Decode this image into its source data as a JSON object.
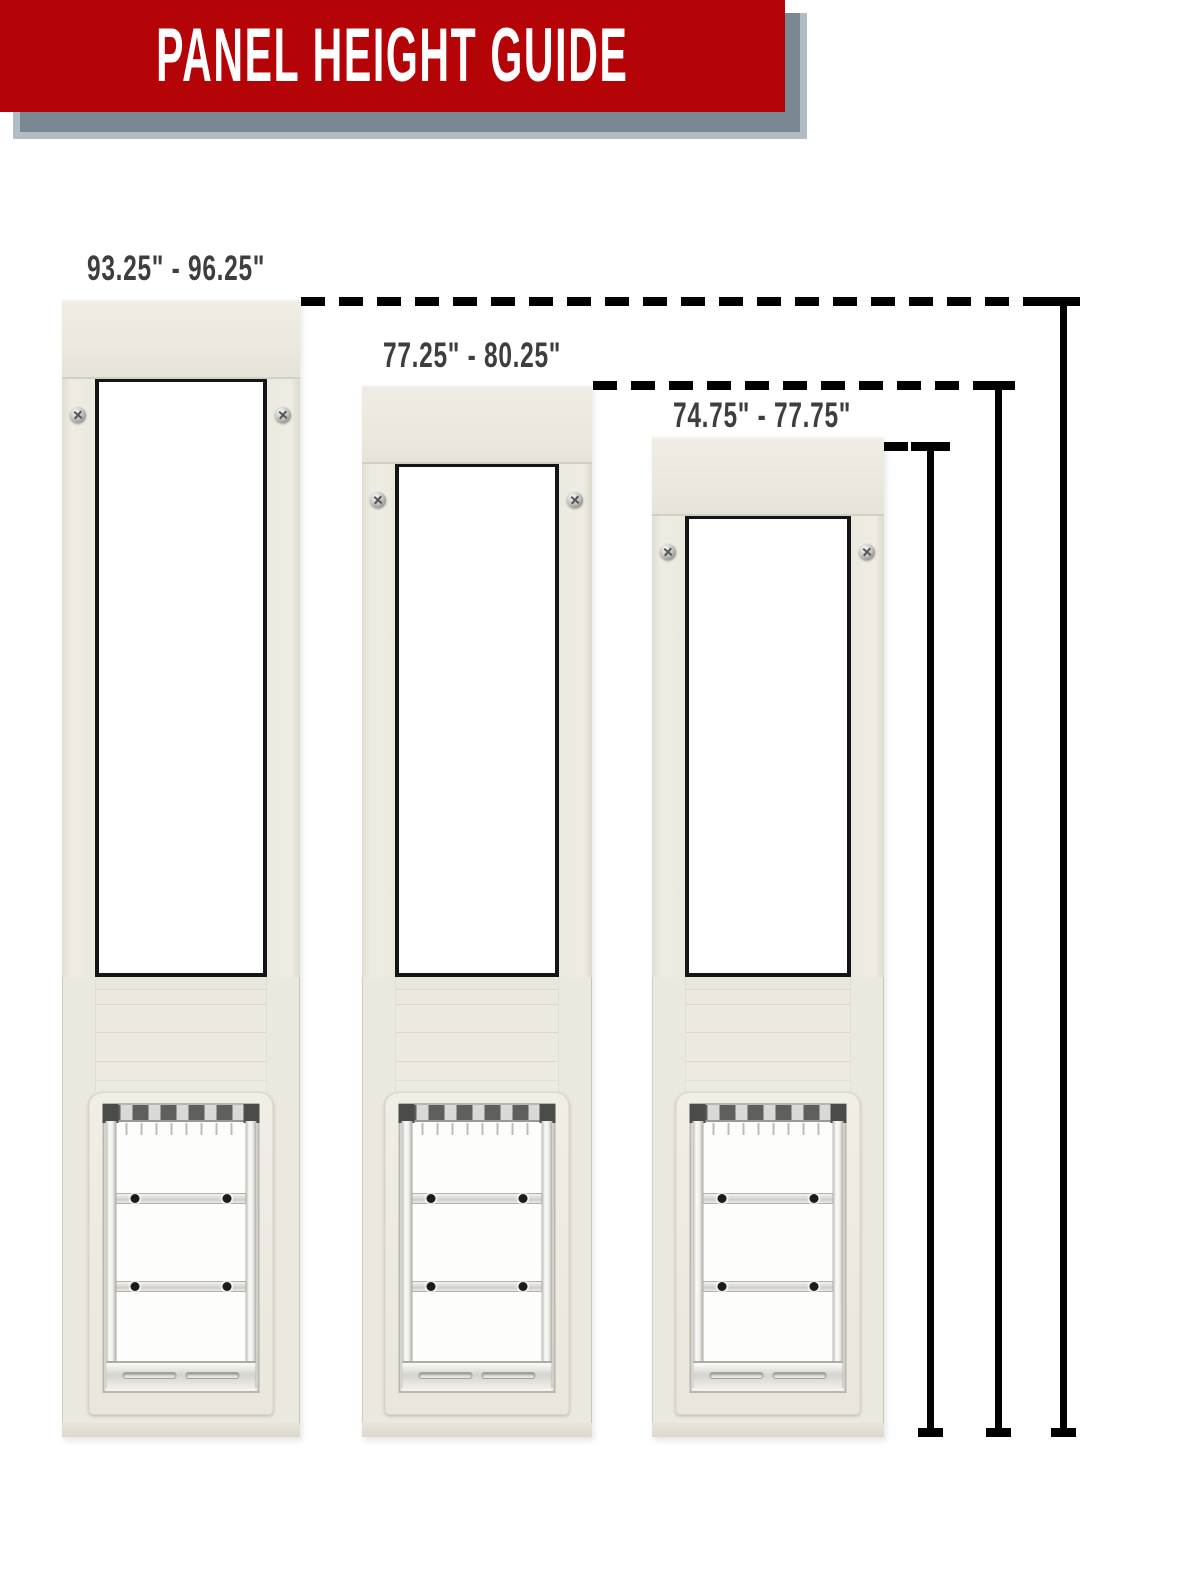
{
  "header": {
    "title": "PANEL HEIGHT GUIDE"
  },
  "panels": [
    {
      "name": "tall-panel",
      "height_range": "93.25\" - 96.25\""
    },
    {
      "name": "medium-panel",
      "height_range": "77.25\" - 80.25\""
    },
    {
      "name": "short-panel",
      "height_range": "74.75\" - 77.75\""
    }
  ],
  "colors": {
    "banner_red": "#b50408",
    "banner_shadow_gray": "#7b8792",
    "banner_shadow_edge": "#b3bcc4",
    "label_text": "#3e3e3e",
    "measurement_line": "#000000",
    "panel_frame_cream": "#ebe8df",
    "glass_border": "#151515"
  }
}
